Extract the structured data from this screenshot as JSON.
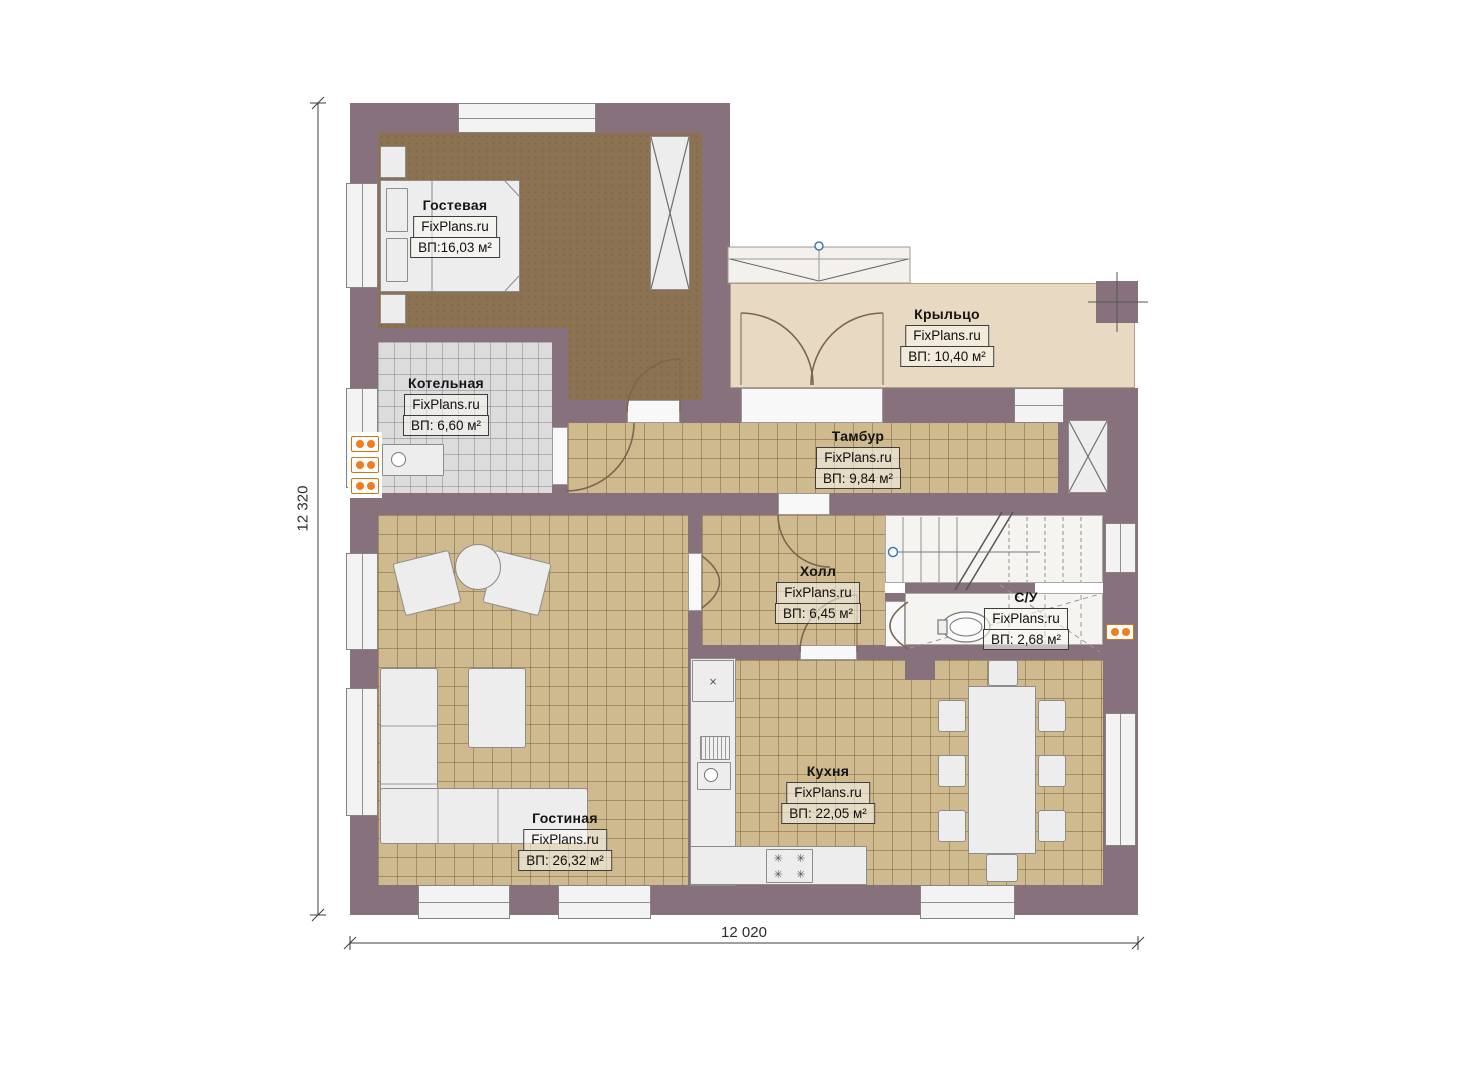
{
  "plan": {
    "brand": "FixPlans.ru",
    "dimensions": {
      "height_label": "12 320",
      "width_label": "12 020"
    },
    "colors": {
      "wall": "#86717c",
      "tile": "#cfb98f",
      "guest_floor": "#8b7252",
      "boiler_floor": "#dcdcdc",
      "porch_floor": "#e8d9c2",
      "furniture": "#ededed",
      "radiator": "#f07d1e",
      "marker": "#3f7cae"
    },
    "rooms": [
      {
        "id": "guest",
        "name": "Гостевая",
        "brand": "FixPlans.ru",
        "area": "ВП:16,03 м²"
      },
      {
        "id": "boiler",
        "name": "Котельная",
        "brand": "FixPlans.ru",
        "area": "ВП: 6,60 м²"
      },
      {
        "id": "porch",
        "name": "Крыльцо",
        "brand": "FixPlans.ru",
        "area": "ВП: 10,40 м²"
      },
      {
        "id": "vestibule",
        "name": "Тамбур",
        "brand": "FixPlans.ru",
        "area": "ВП: 9,84 м²"
      },
      {
        "id": "hall",
        "name": "Холл",
        "brand": "FixPlans.ru",
        "area": "ВП: 6,45 м²"
      },
      {
        "id": "wc",
        "name": "С/У",
        "brand": "FixPlans.ru",
        "area": "ВП: 2,68 м²"
      },
      {
        "id": "kitchen",
        "name": "Кухня",
        "brand": "FixPlans.ru",
        "area": "ВП: 22,05 м²"
      },
      {
        "id": "living",
        "name": "Гостиная",
        "brand": "FixPlans.ru",
        "area": "ВП: 26,32 м²"
      }
    ],
    "stove_burner_glyph": "✳",
    "counter_sink_glyph": "×"
  }
}
